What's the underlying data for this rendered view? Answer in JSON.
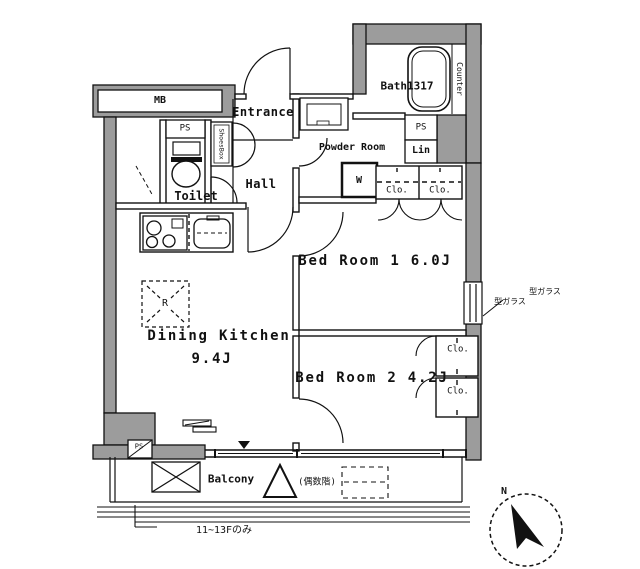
{
  "labels": {
    "meter_box": "MB",
    "pipe_space": "PS",
    "toilet": "Toilet",
    "entrance": "Entrance",
    "hall": "Hall",
    "shoes_box": "ShoesBox",
    "powder_room": "Powder Room",
    "bath": "Bath1317",
    "bath_counter": "Counter",
    "linen": "Lin",
    "washer_mark": "W",
    "closet": "Clo.",
    "bedroom1": "Bed Room 1 6.0J",
    "bedroom2": "Bed Room 2 4.2J",
    "dining_kitchen": "Dining Kitchen",
    "dining_kitchen_size": "9.4J",
    "fridge_mark": "R",
    "frosted_glass": "型ガラス",
    "balcony": "Balcony",
    "hatch_floor_note": "(偶数階)",
    "bottom_floor_note": "11~13Fのみ",
    "compass_north": "N"
  },
  "colors": {
    "wall_fill": "#9c9c9c",
    "line": "#111111",
    "background": "#ffffff"
  }
}
